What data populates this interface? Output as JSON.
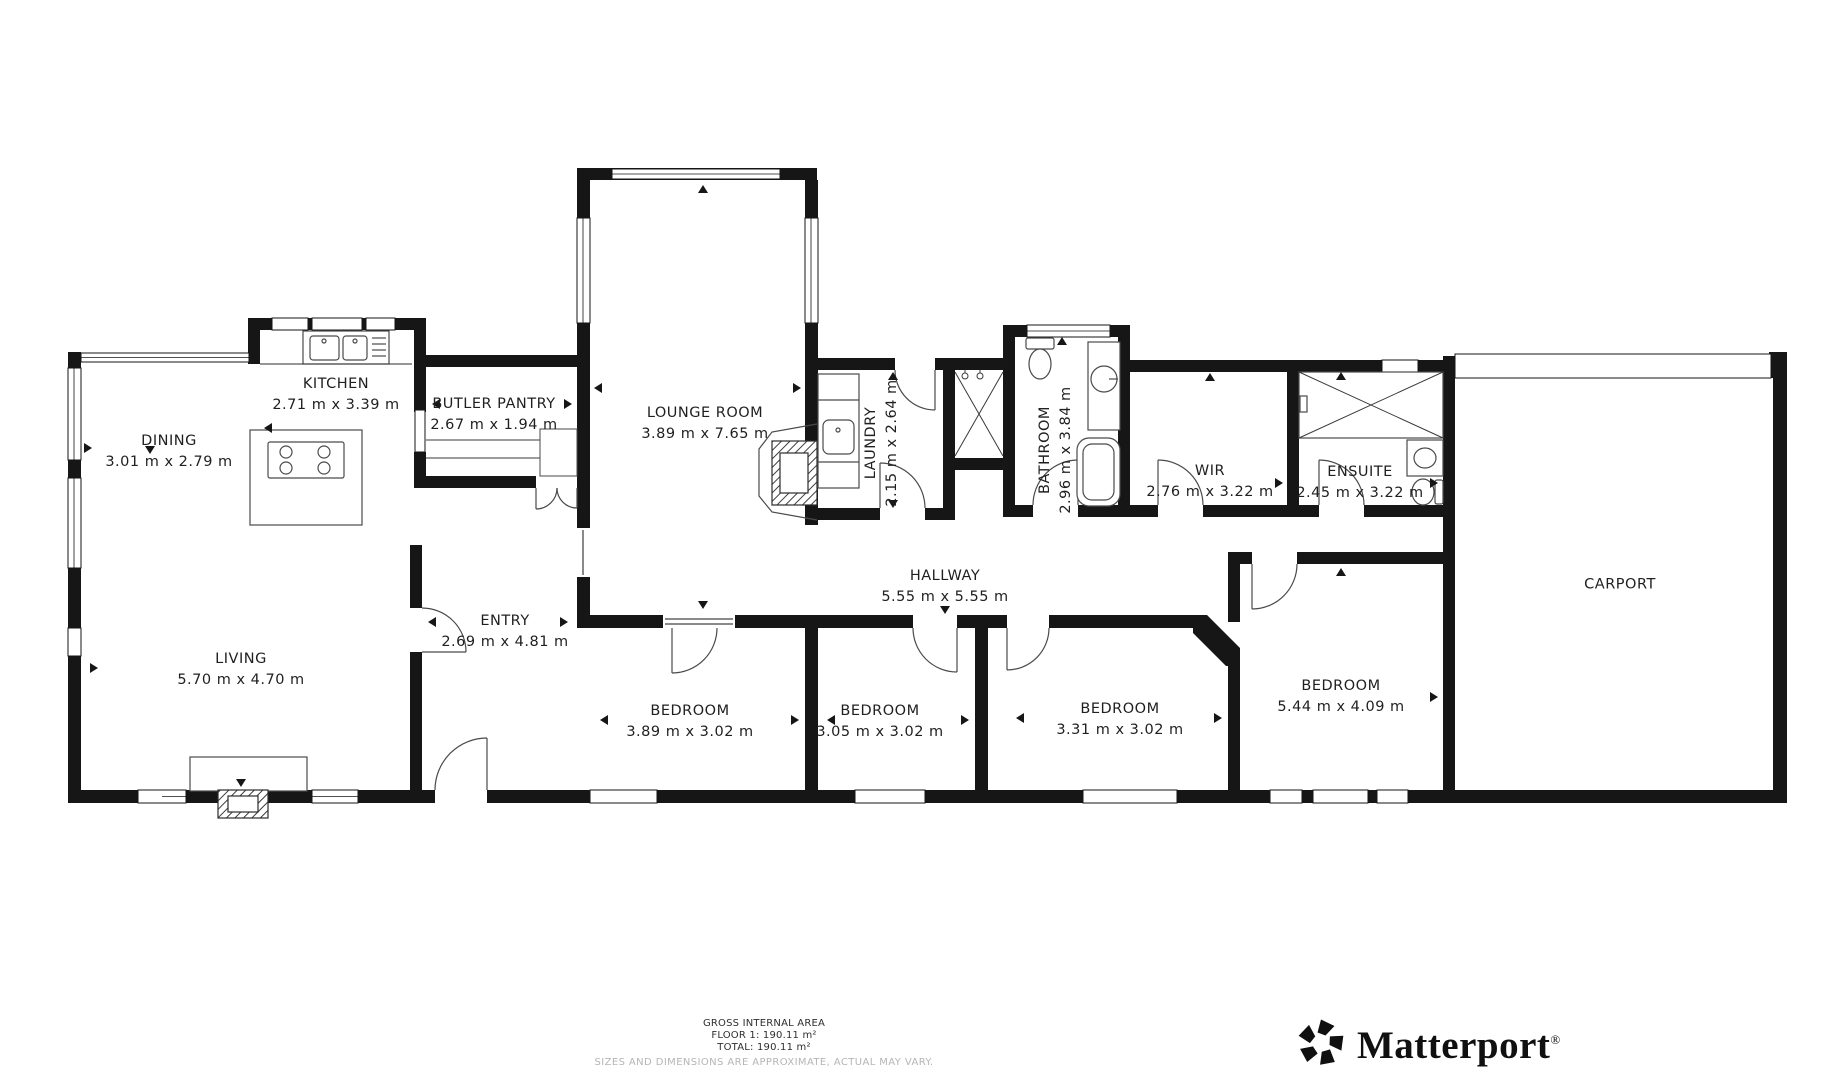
{
  "colors": {
    "wall": "#161616",
    "background": "#ffffff",
    "label_text": "#1f1f1f",
    "disclaimer": "#b5b5b5"
  },
  "rooms": [
    {
      "name": "KITCHEN",
      "dims": "2.71 m x 3.39 m",
      "orientation": "horizontal"
    },
    {
      "name": "DINING",
      "dims": "3.01 m x 2.79 m",
      "orientation": "horizontal"
    },
    {
      "name": "BUTLER PANTRY",
      "dims": "2.67 m x 1.94 m",
      "orientation": "horizontal"
    },
    {
      "name": "LOUNGE ROOM",
      "dims": "3.89 m x 7.65 m",
      "orientation": "horizontal"
    },
    {
      "name": "LAUNDRY",
      "dims": "2.15 m x 2.64 m",
      "orientation": "vertical"
    },
    {
      "name": "BATHROOM",
      "dims": "2.96 m x 3.84 m",
      "orientation": "vertical"
    },
    {
      "name": "WIR",
      "dims": "2.76 m x 3.22 m",
      "orientation": "horizontal"
    },
    {
      "name": "ENSUITE",
      "dims": "2.45 m x 3.22 m",
      "orientation": "horizontal"
    },
    {
      "name": "CARPORT",
      "dims": "",
      "orientation": "horizontal"
    },
    {
      "name": "HALLWAY",
      "dims": "5.55 m x 5.55 m",
      "orientation": "horizontal"
    },
    {
      "name": "ENTRY",
      "dims": "2.69 m x 4.81 m",
      "orientation": "horizontal"
    },
    {
      "name": "LIVING",
      "dims": "5.70 m x 4.70 m",
      "orientation": "horizontal"
    },
    {
      "name": "BEDROOM",
      "dims": "3.89 m x 3.02 m",
      "orientation": "horizontal"
    },
    {
      "name": "BEDROOM",
      "dims": "3.05 m x 3.02 m",
      "orientation": "horizontal"
    },
    {
      "name": "BEDROOM",
      "dims": "3.31 m x 3.02 m",
      "orientation": "horizontal"
    },
    {
      "name": "BEDROOM",
      "dims": "5.44 m x 4.09 m",
      "orientation": "horizontal"
    }
  ],
  "footer": {
    "title": "GROSS INTERNAL AREA",
    "floor_line": "FLOOR 1: 190.11 m²",
    "total_line": "TOTAL: 190.11 m²",
    "disclaimer": "SIZES AND DIMENSIONS ARE APPROXIMATE, ACTUAL MAY VARY."
  },
  "branding": {
    "name": "Matterport",
    "registered_mark": "®"
  }
}
